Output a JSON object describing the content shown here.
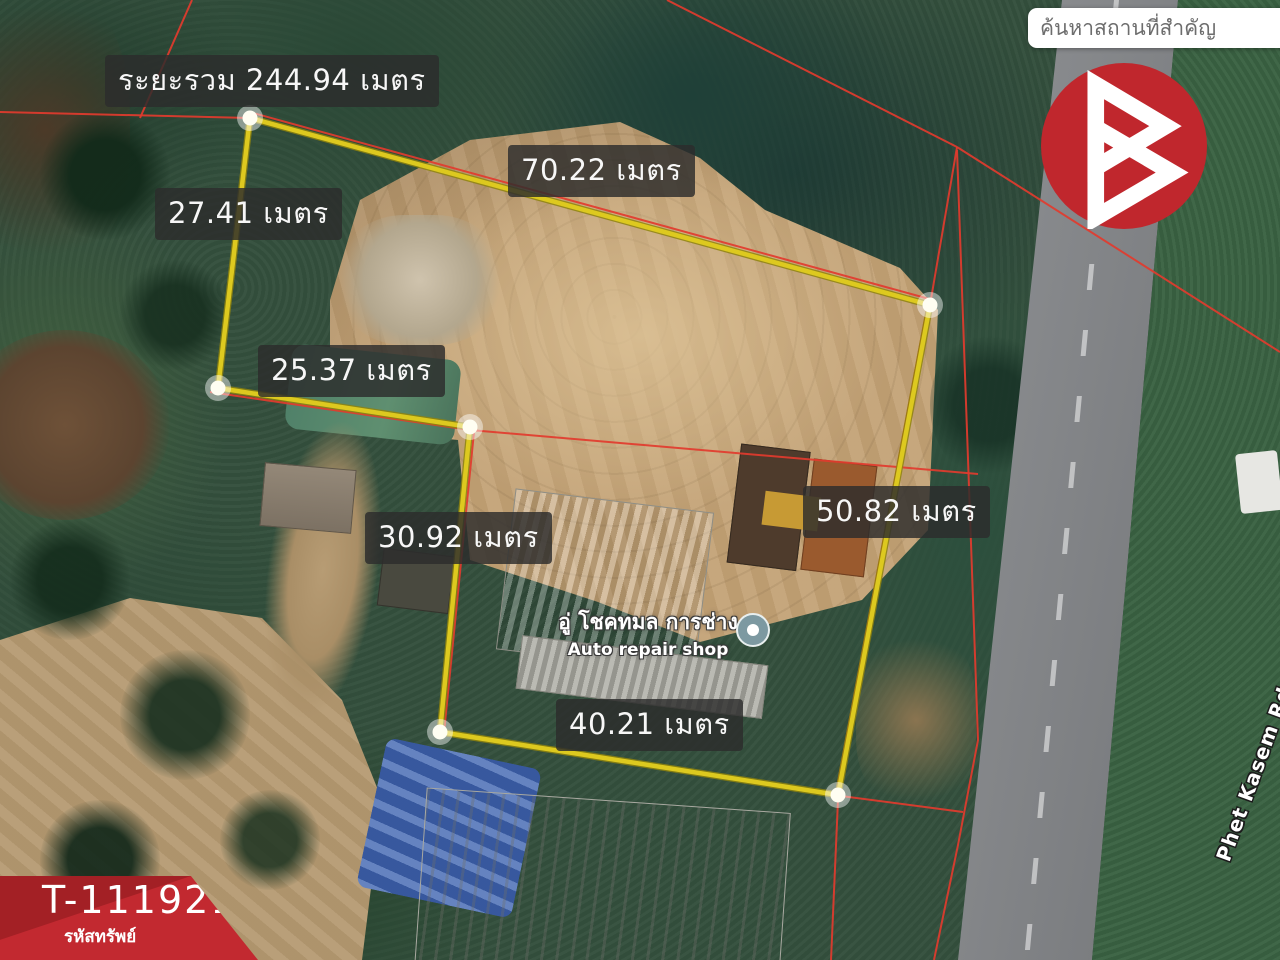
{
  "search": {
    "placeholder": "ค้นหาสถานที่สำคัญ"
  },
  "colors": {
    "accent_red": "#c0272d",
    "banner_red": "#c22930",
    "banner_red_dark": "#a32025",
    "survey_yellow": "#ddc91f",
    "survey_yellow_edge": "#8f840e",
    "parcel_red": "#e23b2e"
  },
  "poi": {
    "title_th": "อู่ โชคทมล การช่าง",
    "subtitle_en": "Auto repair shop"
  },
  "road_label": "Phet Kasem Rd",
  "property_tag": {
    "code": "T-111921",
    "caption": "รหัสทรัพย์"
  },
  "survey": {
    "total_meters": 244.94,
    "unit_th": "เมตร",
    "side_labels": [
      {
        "id": "total",
        "text": "ระยะรวม 244.94 เมตร",
        "meters": 244.94
      },
      {
        "id": "top",
        "text": "70.22 เมตร",
        "meters": 70.22
      },
      {
        "id": "upper-left",
        "text": "27.41 เมตร",
        "meters": 27.41
      },
      {
        "id": "mid-left",
        "text": "25.37 เมตร",
        "meters": 25.37
      },
      {
        "id": "lower-left",
        "text": "30.92 เมตร",
        "meters": 30.92
      },
      {
        "id": "right",
        "text": "50.82 เมตร",
        "meters": 50.82
      },
      {
        "id": "bottom",
        "text": "40.21 เมตร",
        "meters": 40.21
      }
    ],
    "vertices": [
      [
        250,
        118
      ],
      [
        930,
        305
      ],
      [
        838,
        795
      ],
      [
        440,
        732
      ],
      [
        470,
        427
      ],
      [
        218,
        388
      ]
    ],
    "yellow_edges": [
      [
        0,
        1
      ],
      [
        0,
        5
      ],
      [
        5,
        4
      ],
      [
        4,
        3
      ],
      [
        3,
        2
      ],
      [
        2,
        1
      ]
    ],
    "red_polylines": [
      [
        [
          0,
          112
        ],
        [
          250,
          118
        ]
      ],
      [
        [
          192,
          0
        ],
        [
          140,
          118
        ]
      ],
      [
        [
          667,
          0
        ],
        [
          957,
          147
        ]
      ],
      [
        [
          957,
          147
        ],
        [
          1280,
          352
        ]
      ],
      [
        [
          957,
          147
        ],
        [
          930,
          305
        ]
      ],
      [
        [
          253,
          113
        ],
        [
          933,
          300
        ]
      ],
      [
        [
          927,
          308
        ],
        [
          836,
          793
        ]
      ],
      [
        [
          210,
          392
        ],
        [
          470,
          430
        ],
        [
          978,
          474
        ]
      ],
      [
        [
          474,
          432
        ],
        [
          444,
          733
        ]
      ],
      [
        [
          957,
          150
        ],
        [
          978,
          740
        ],
        [
          958,
          845
        ],
        [
          934,
          960
        ]
      ],
      [
        [
          841,
          796
        ],
        [
          963,
          812
        ]
      ],
      [
        [
          838,
          800
        ],
        [
          831,
          960
        ]
      ]
    ]
  }
}
